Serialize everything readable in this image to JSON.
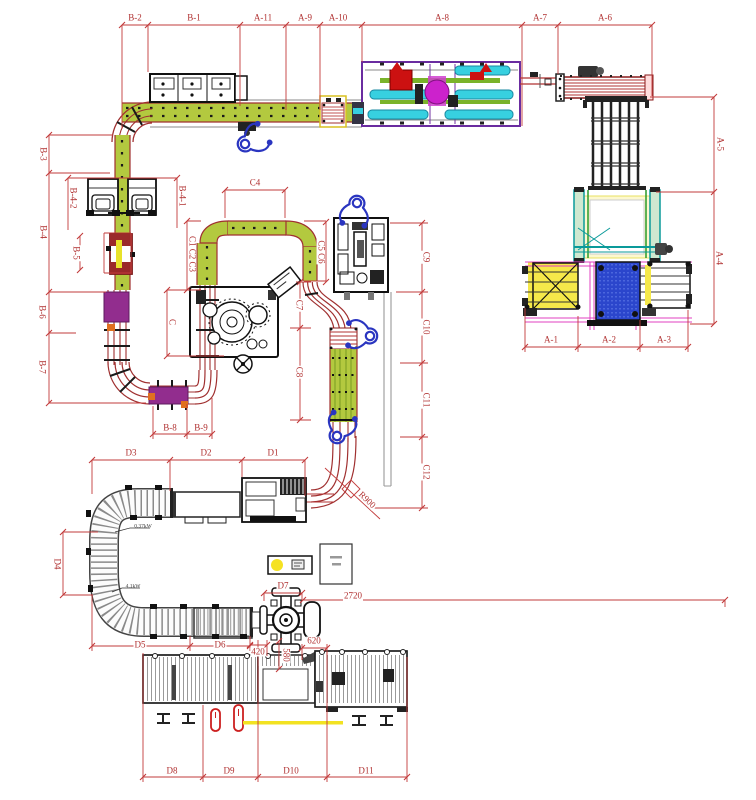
{
  "drawing_labels": {
    "b2": "B-2",
    "b1": "B-1",
    "a11": "A-11",
    "a9": "A-9",
    "a10": "A-10",
    "a8": "A-8",
    "a7": "A-7",
    "a6": "A-6",
    "a5": "A-5",
    "a4": "A-4",
    "a1": "A-1",
    "a2": "A-2",
    "a3": "A-3",
    "b3": "B-3",
    "b4": "B-4",
    "b42": "B-4-2",
    "b41": "B-4-1",
    "b5": "B-5",
    "b6": "B-6",
    "b7": "B-7",
    "b8": "B-8",
    "b9": "B-9",
    "c": "C",
    "c123": "C1 C2 C3",
    "c4": "C4",
    "c56": "C5 C6",
    "c7": "C7",
    "c8": "C8",
    "c9": "C9",
    "c10": "C10",
    "c11": "C11",
    "c12": "C12",
    "r900": "R900",
    "d1": "D1",
    "d2": "D2",
    "d3": "D3",
    "d4": "D4",
    "d5": "D5",
    "d6": "D6",
    "d7": "D7",
    "d8": "D8",
    "d9": "D9",
    "d10": "D10",
    "d11": "D11",
    "dim2720": "2720",
    "dim620": "620",
    "dim580": "580",
    "dim420": "420",
    "kw1": "0.37kW",
    "kw2": "4.1kW"
  },
  "colors": {
    "dimension_red": "#c23b3b",
    "label_red": "#b03030",
    "conveyor_green": "#b3c93f",
    "conveyor_edge": "#a03030",
    "machine_purple": "#6a2ca0",
    "block_purple": "#922d8e",
    "magenta": "#cc22cc",
    "cyan": "#37d0e0",
    "operator_blue": "#2a35c0",
    "pallet_blue": "#2b46cc",
    "highlight_yellow": "#f5e84a"
  }
}
